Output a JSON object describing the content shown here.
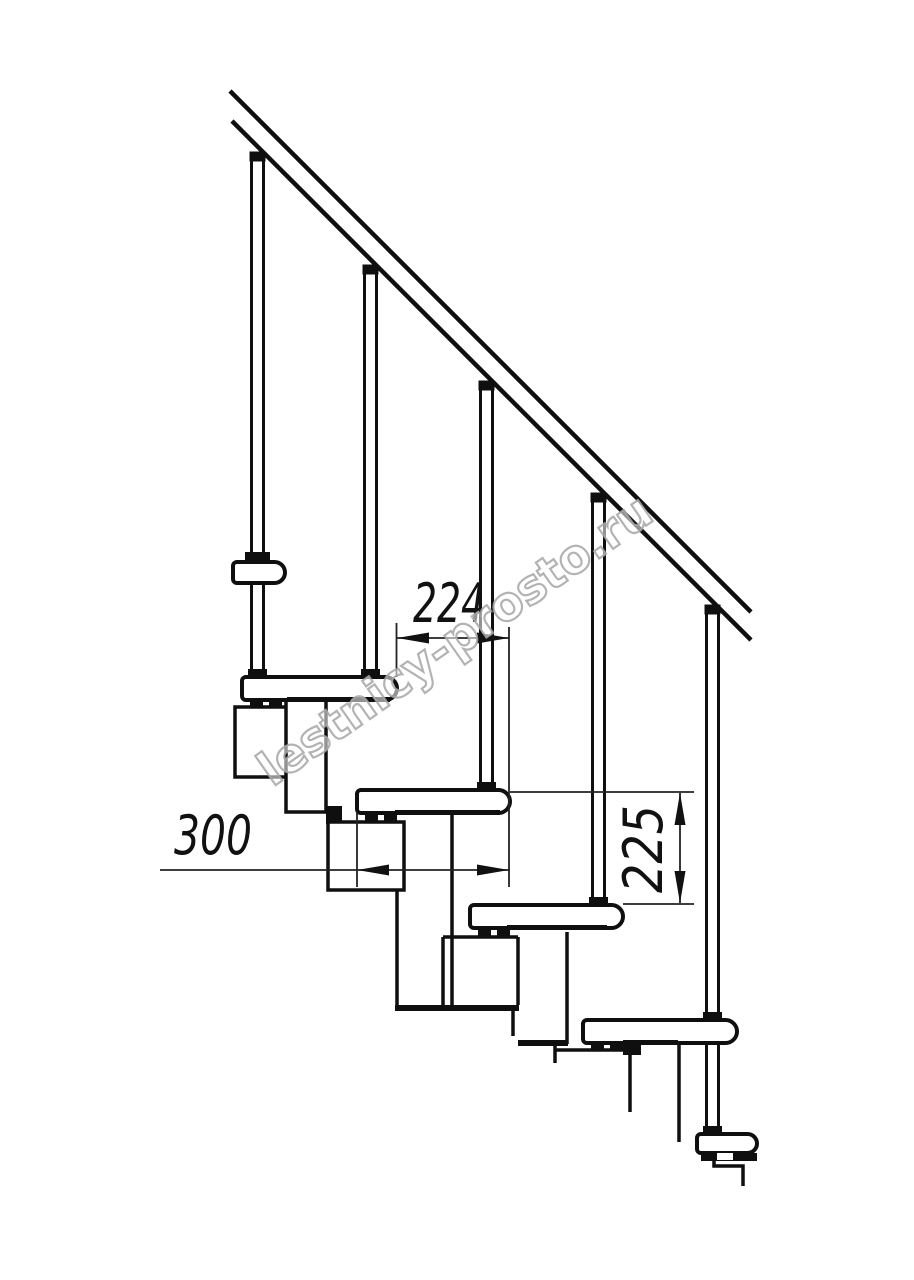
{
  "drawing": {
    "title": "staircase-side-elevation",
    "watermark_text": "lestnicy-prosto.ru",
    "dimensions": {
      "going_label": "224",
      "tread_depth_label": "300",
      "rise_label": "225"
    },
    "counts": {
      "treads": 4,
      "balusters": 5
    },
    "colors": {
      "line": "#0f0f0f",
      "dimension": "#222222",
      "watermark_outline": "#a6a6a6",
      "background": "#ffffff"
    }
  }
}
